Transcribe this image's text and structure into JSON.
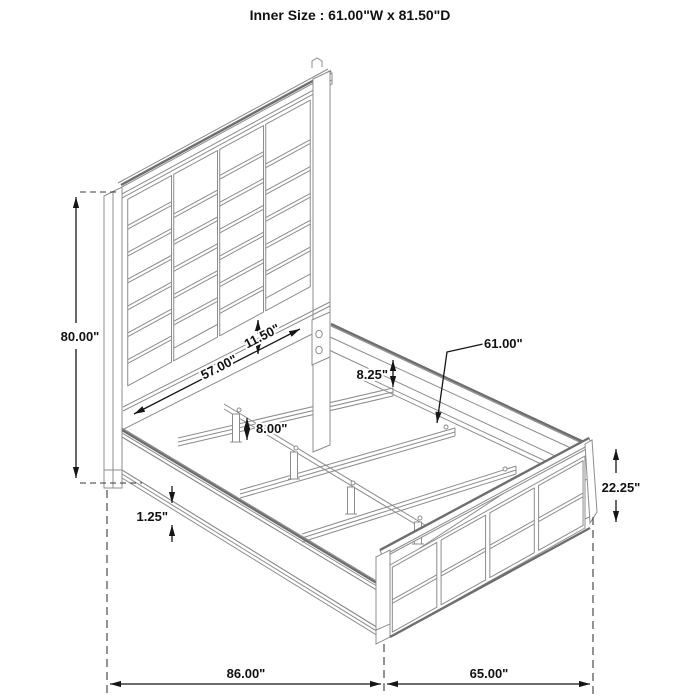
{
  "title": "Inner Size : 61.00\"W x 81.50\"D",
  "diagram": {
    "subject": "upholstered-panel-bed-frame-dimension-drawing",
    "inner_size": {
      "width": "61.00\"",
      "depth": "81.50\""
    },
    "colors": {
      "structure": "#8c8c8c",
      "dimension": "#151515",
      "background": "#ffffff"
    },
    "dims": {
      "headboard_height": {
        "label": "80.00\"",
        "measures": "overall headboard height"
      },
      "headboard_rail_width": {
        "label": "57.00\"",
        "measures": "headboard lower rail width"
      },
      "panel_to_rail_gap": {
        "label": "11.50\"",
        "measures": "gap under headboard panel"
      },
      "rail_to_slat": {
        "label": "8.25\"",
        "measures": "side rail to slat drop"
      },
      "slat_length": {
        "label": "61.00\"",
        "measures": "slat / inner width"
      },
      "leg_height": {
        "label": "8.00\"",
        "measures": "center support leg height"
      },
      "rail_lip": {
        "label": "1.25\"",
        "measures": "side rail lip thickness"
      },
      "footboard_height": {
        "label": "22.25\"",
        "measures": "footboard height"
      },
      "overall_depth": {
        "label": "86.00\"",
        "measures": "overall depth"
      },
      "overall_width": {
        "label": "65.00\"",
        "measures": "overall width"
      }
    }
  }
}
